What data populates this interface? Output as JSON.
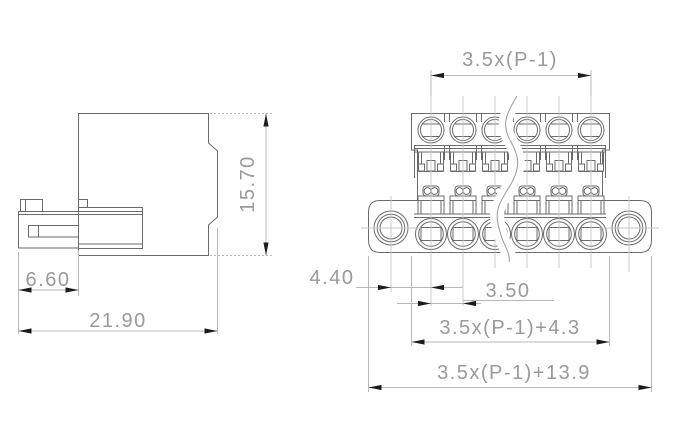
{
  "meta": {
    "drawing_type": "terminal-block connector dimension drawing",
    "poles_shown": 6,
    "views": [
      "side view",
      "front view"
    ]
  },
  "colors": {
    "background": "#ffffff",
    "outline": "#6b6b6b",
    "dim_line": "#b8b8b8",
    "dim_text": "#9a9a9a",
    "arrow": "#1c1c1c",
    "centerline": "#c6c6c6",
    "break_line": "#9a9a9a"
  },
  "labels": {
    "side": {
      "height": "15.70",
      "front_depth": "6.60",
      "total_depth": "21.90"
    },
    "front": {
      "pole_span": "3.5x(P-1)",
      "hole_offset": "4.40",
      "pitch": "3.50",
      "body_width": "3.5x(P-1)+4.3",
      "overall_width": "3.5x(P-1)+13.9"
    }
  }
}
